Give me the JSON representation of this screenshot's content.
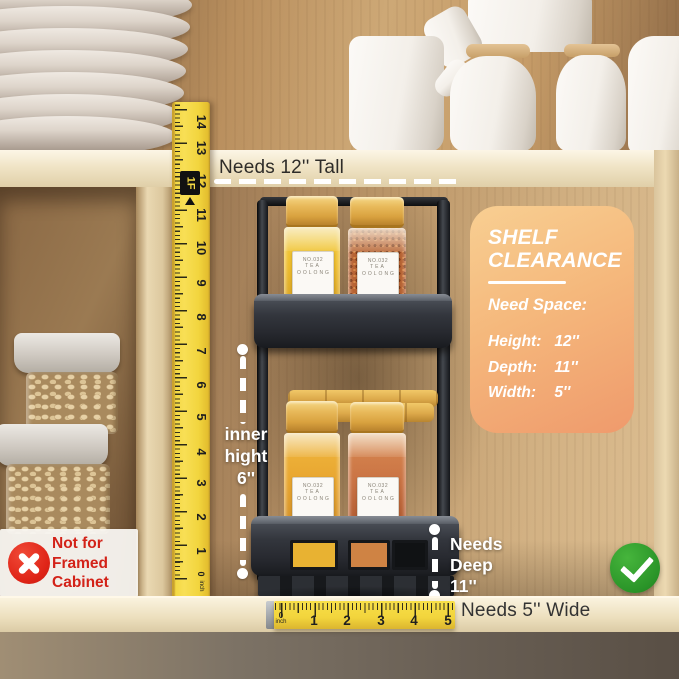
{
  "annotations": {
    "needs_tall": "Needs 12'' Tall",
    "needs_wide": "Needs 5'' Wide",
    "inner_height": [
      "inner",
      "hight",
      "6''"
    ],
    "needs_deep": [
      "Needs",
      "Deep",
      "11''"
    ],
    "not_for_framed": [
      "Not for",
      "Framed",
      "Cabinet"
    ]
  },
  "clearance_card": {
    "title": [
      "SHELF",
      "CLEARANCE"
    ],
    "subtitle": "Need Space:",
    "specs": [
      {
        "label": "Height:",
        "value": "12''"
      },
      {
        "label": "Depth:",
        "value": "11''"
      },
      {
        "label": "Width:",
        "value": "5''"
      }
    ]
  },
  "vertical_ruler": {
    "numbers": [
      "14",
      "13",
      "12",
      "11",
      "10",
      "9",
      "8",
      "7",
      "6",
      "5",
      "4",
      "3",
      "2",
      "1"
    ],
    "zero": "0",
    "unit": "inch",
    "foot_marker": "1F"
  },
  "horizontal_ruler": {
    "numbers": [
      "1",
      "2",
      "3",
      "4",
      "5"
    ],
    "zero": "0",
    "unit": "inch"
  },
  "spice_jar_label": {
    "code": "NO.032",
    "name": "TEA OOLONG"
  },
  "colors": {
    "tape_yellow": "#F2D53E",
    "card_gradient_start": "#F8CF92",
    "card_gradient_end": "#EF9A6C",
    "alert_red": "#DF2417",
    "check_green": "#2A9428",
    "annotation_white": "#FFFFFF",
    "annotation_dark": "#2E2C29"
  }
}
